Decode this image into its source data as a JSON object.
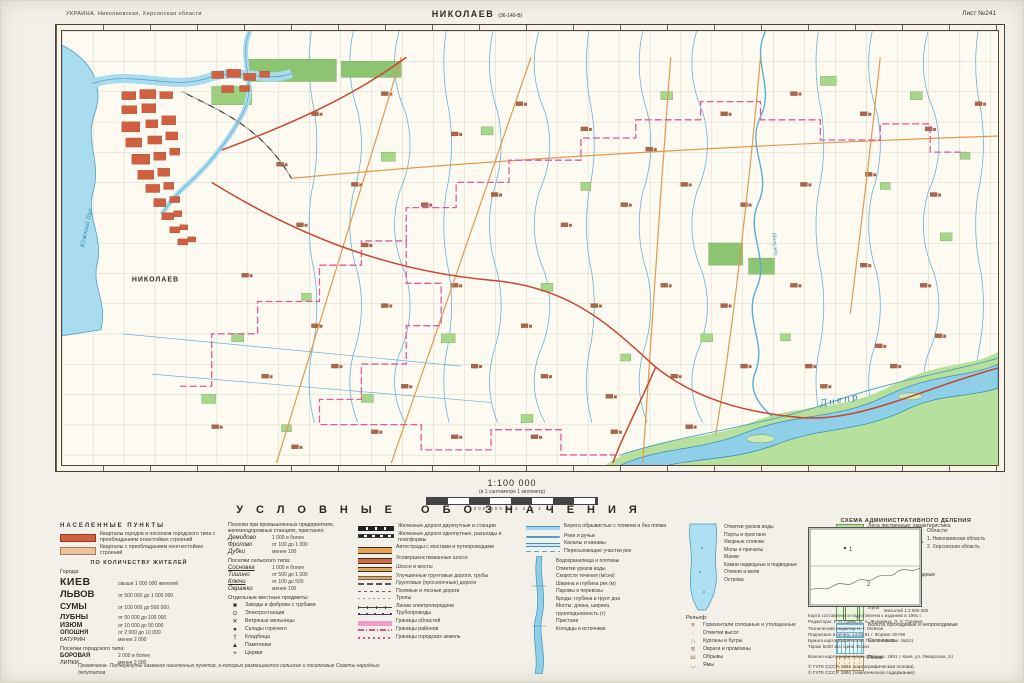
{
  "header": {
    "series_title": "УКРАИНА. Николаевская, Херсонская области",
    "map_title": "НИКОЛАЕВ",
    "map_title_note": "(36-140-В)",
    "sheet_number": "Лист №241"
  },
  "scale": {
    "ratio": "1:100 000",
    "note": "(в 1 сантиметре 1 километр)",
    "bar_labels": "1000  500  0  1  2  3  4 км"
  },
  "map": {
    "labels": {
      "city": "НИКОЛАЕВ",
      "river_dnepr": "Днепр",
      "river_bug": "Южный Буг",
      "river_ingulets": "Ингулец"
    }
  },
  "legend": {
    "title": "УСЛОВНЫЕ ОБОЗНАЧЕНИЯ",
    "settlements": {
      "heading": "НАСЕЛЕННЫЕ ПУНКТЫ",
      "blocks": [
        {
          "sym": "blk-fire",
          "label": "Кварталы городов и поселков городского типа с преобладанием огнестойких строений"
        },
        {
          "sym": "blk-nonfire",
          "label": "Кварталы с преобладанием неогнестойких строений"
        }
      ],
      "by_population": "ПО КОЛИЧЕСТВУ ЖИТЕЛЕЙ",
      "towns_heading": "Города:",
      "towns": [
        {
          "name": "КИЕВ",
          "cls": "t1",
          "desc": "свыше 1 000 000 жителей"
        },
        {
          "name": "ЛЬВОВ",
          "cls": "t2",
          "desc": "от 500 000 до 1 000 000"
        },
        {
          "name": "СУМЫ",
          "cls": "t3",
          "desc": "от 100 000 до 500 000"
        },
        {
          "name": "ЛУБНЫ",
          "cls": "t4",
          "desc": "от 50 000 до 100 000"
        },
        {
          "name": "ИЗЮМ",
          "cls": "t5",
          "desc": "от 10 000 до 50 000"
        },
        {
          "name": "ОПОШНЯ",
          "cls": "t6",
          "desc": "от 2 000 до 10 000"
        },
        {
          "name": "БАТУРИН",
          "cls": "t7",
          "desc": "менее 2 000"
        }
      ],
      "pgt_heading": "Поселки городского типа:",
      "pgt": [
        {
          "name": "БОРОВАЯ",
          "cls": "t6",
          "desc": "2 000 и более"
        },
        {
          "name": "ЛИПКИ",
          "cls": "t7",
          "desc": "менее 2 000"
        }
      ]
    },
    "industrial": {
      "heading": "Поселки при промышленных предприятиях, железнодорожных станциях, пристанях:",
      "items": [
        {
          "name": "Демидово",
          "desc": "1 000 и более"
        },
        {
          "name": "Фролово",
          "desc": "от 100 до 1 000"
        },
        {
          "name": "Дубки",
          "desc": "менее 100"
        }
      ],
      "rural_heading": "Поселки сельского типа:",
      "rural": [
        {
          "name": "Сосновка",
          "cls": "u",
          "desc": "1 000 и более"
        },
        {
          "name": "Тишино",
          "desc": "от 500 до 1 000"
        },
        {
          "name": "Ключи",
          "cls": "u",
          "desc": "от 100 до 500"
        },
        {
          "name": "Овражки",
          "desc": "менее 100"
        }
      ],
      "objects_heading": "Отдельные местные предметы:",
      "objects": [
        {
          "glyph": "■",
          "label": "Заводы и фабрики с трубами"
        },
        {
          "glyph": "⊙",
          "label": "Электростанции"
        },
        {
          "glyph": "✕",
          "label": "Ветряные мельницы"
        },
        {
          "glyph": "●",
          "label": "Склады горючего"
        },
        {
          "glyph": "†",
          "label": "Кладбища"
        },
        {
          "glyph": "▲",
          "label": "Памятники"
        },
        {
          "glyph": "+",
          "label": "Церкви"
        }
      ]
    },
    "roads": {
      "items": [
        {
          "sym": "r-rail2",
          "label": "Железные дороги двухпутные и станции"
        },
        {
          "sym": "r-rail1",
          "label": "Железные дороги однопутные, разъезды и платформы"
        },
        {
          "sym": "r-auto",
          "label": "Автострады с мостами и путепроводами"
        },
        {
          "sym": "r-hwy1",
          "label": "Усовершенствованные шоссе"
        },
        {
          "sym": "r-hwy2",
          "label": "Шоссе и мосты"
        },
        {
          "sym": "r-grunt1",
          "label": "Улучшенные грунтовые дороги, трубы"
        },
        {
          "sym": "r-grunt2",
          "label": "Грунтовые (проселочные) дороги"
        },
        {
          "sym": "r-field",
          "label": "Полевые и лесные дороги"
        },
        {
          "sym": "r-trail",
          "label": "Тропы"
        },
        {
          "sym": "r-power",
          "label": "Линии электропередачи"
        },
        {
          "sym": "r-pipe",
          "label": "Трубопроводы"
        },
        {
          "sym": "r-bound1",
          "label": "Границы областей"
        },
        {
          "sym": "r-bound2",
          "label": "Границы районов"
        },
        {
          "sym": "r-bound3",
          "label": "Границы городских земель"
        }
      ]
    },
    "hydro": {
      "items": [
        {
          "sym": "h-shore",
          "label": "Берега обрывистые с пляжем и без пляжа"
        },
        {
          "sym": "h-river",
          "label": "Реки и ручьи"
        },
        {
          "sym": "h-canal",
          "label": "Каналы и канавы"
        },
        {
          "sym": "h-dry",
          "label": "Пересыхающие участки рек"
        }
      ],
      "callouts": [
        "Водохранилища и плотины",
        "Отметки урезов воды",
        "Скорости течения (м/сек)",
        "Ширина и глубина рек (м)",
        "Паромы и перевозы",
        "Броды: глубина и грунт дна",
        "Мосты: длина, ширина,",
        "грузоподъемность (т)",
        "Пристани",
        "Колодцы и источники"
      ]
    },
    "water": {
      "callouts": [
        "Отметки урезов воды",
        "Порты и пристани",
        "Якорные стоянки",
        "Молы и причалы",
        "Маяки",
        "Камни надводные и подводные",
        "Отмели и мели",
        "Острова"
      ],
      "relief_heading": "Рельеф:",
      "relief": [
        {
          "glyph": "≡",
          "label": "Горизонтали сплошные и утолщенные"
        },
        {
          "glyph": "·",
          "label": "Отметки высот"
        },
        {
          "glyph": "∩",
          "label": "Курганы и бугры"
        },
        {
          "glyph": "≋",
          "label": "Овраги и промоины"
        },
        {
          "glyph": "ш",
          "label": "Обрывы"
        },
        {
          "glyph": "◡",
          "label": "Ямы"
        }
      ]
    },
    "vegetation": {
      "items": [
        {
          "sym": "v-forest",
          "label": "Леса лиственные; характеристика древостоя в метрах"
        },
        {
          "sym": "v-sparse",
          "label": "Редкие леса и поросль"
        },
        {
          "sym": "v-shrub",
          "label": "Кустарники"
        },
        {
          "sym": "v-orchard",
          "label": "Сады фруктовые и ягодные"
        },
        {
          "sym": "v-vine",
          "label": "Виноградники"
        },
        {
          "sym": "v-meadow",
          "label": "Луга"
        },
        {
          "sym": "v-swamp",
          "label": "Болота проходимые и непроходимые"
        },
        {
          "sym": "v-salt",
          "label": "Солончаки"
        },
        {
          "sym": "v-sand",
          "label": "Пески"
        }
      ]
    },
    "schema": {
      "title": "СХЕМА АДМИНИСТРАТИВНОГО ДЕЛЕНИЯ",
      "list_heading": "Области:",
      "areas": [
        "1. Николаевская область",
        "2. Херсонская область"
      ],
      "scale": "Масштаб 1:2 500 000"
    },
    "note": "Примечание. Подчеркнуты названия населенных пунктов, в которых размещаются сельские и поселковые Советы народных депутатов.",
    "credits": {
      "lines": [
        "Карта составлена и подготовлена к изданию в 1991 г.",
        "Редакторы: Р. Н. Гринь, Е. А. Жуковина, Л. Л. Горевая",
        "Технический редактор Н. Г. Мовчан",
        "Подписано в печать 14.03.91 г. Формат 60×90",
        "Бумага картографическая. Печ. л. 1,5. Зак. №241",
        "Тираж 5000 экз. Цена 45 коп."
      ],
      "address": "Военно-картографическая фабрика. 1991 г. Киев, ул. Январская, 24",
      "copyright": [
        "© ГУГК СССР, 1991 (картографическая основа)",
        "© ГУГК СССР, 1991 (тематическое содержание)"
      ]
    }
  }
}
